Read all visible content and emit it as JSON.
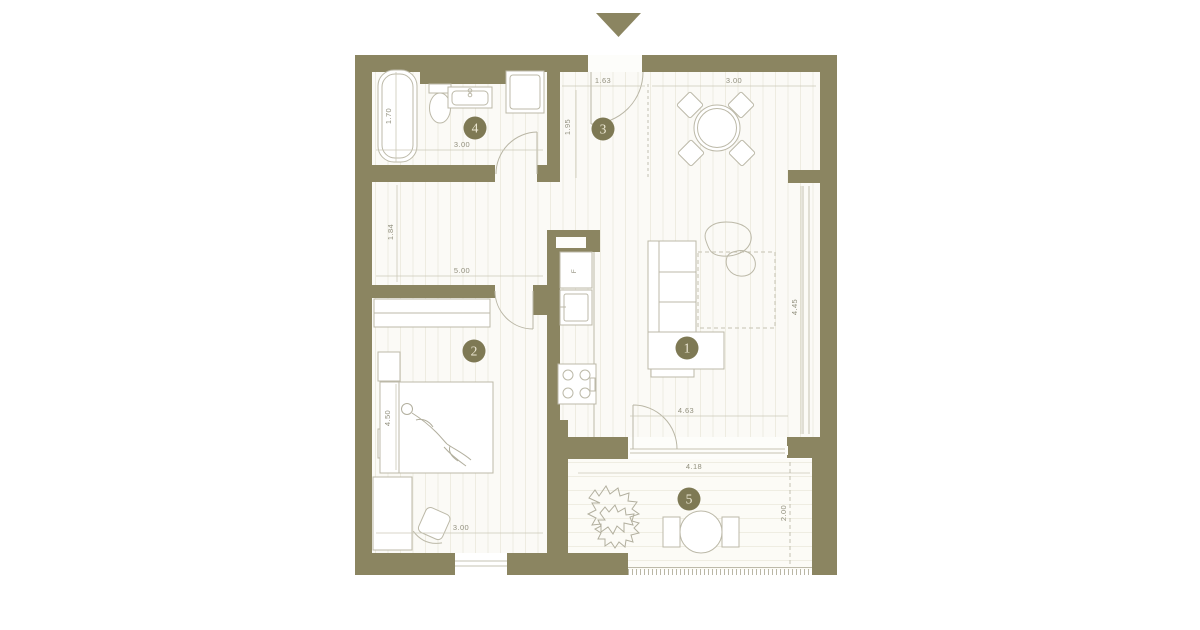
{
  "colors": {
    "wall": "#8b8561",
    "badge_bg": "#7e7954",
    "badge_text": "#eee9d5",
    "dim_text": "#92907e",
    "furniture_stroke": "#bcb9a8",
    "faint_line": "#cbc8b8",
    "dash_line": "#b5b2a1"
  },
  "rooms": [
    {
      "number": "1"
    },
    {
      "number": "2"
    },
    {
      "number": "3"
    },
    {
      "number": "4"
    },
    {
      "number": "5"
    }
  ],
  "dimensions": {
    "hall_width": "1.63",
    "hall_depth": "1.95",
    "dining_width": "3.00",
    "bathroom_width": "3.00",
    "bathtub_length": "1.70",
    "corridor_depth": "1.84",
    "corridor_length": "5.00",
    "bedroom_bed_wall": "4.50",
    "bedroom_width": "3.00",
    "living_depth": "4.45",
    "living_width": "4.63",
    "balcony_width": "4.18",
    "balcony_depth": "2.00"
  },
  "kitchen": {
    "fridge_label": "F"
  }
}
